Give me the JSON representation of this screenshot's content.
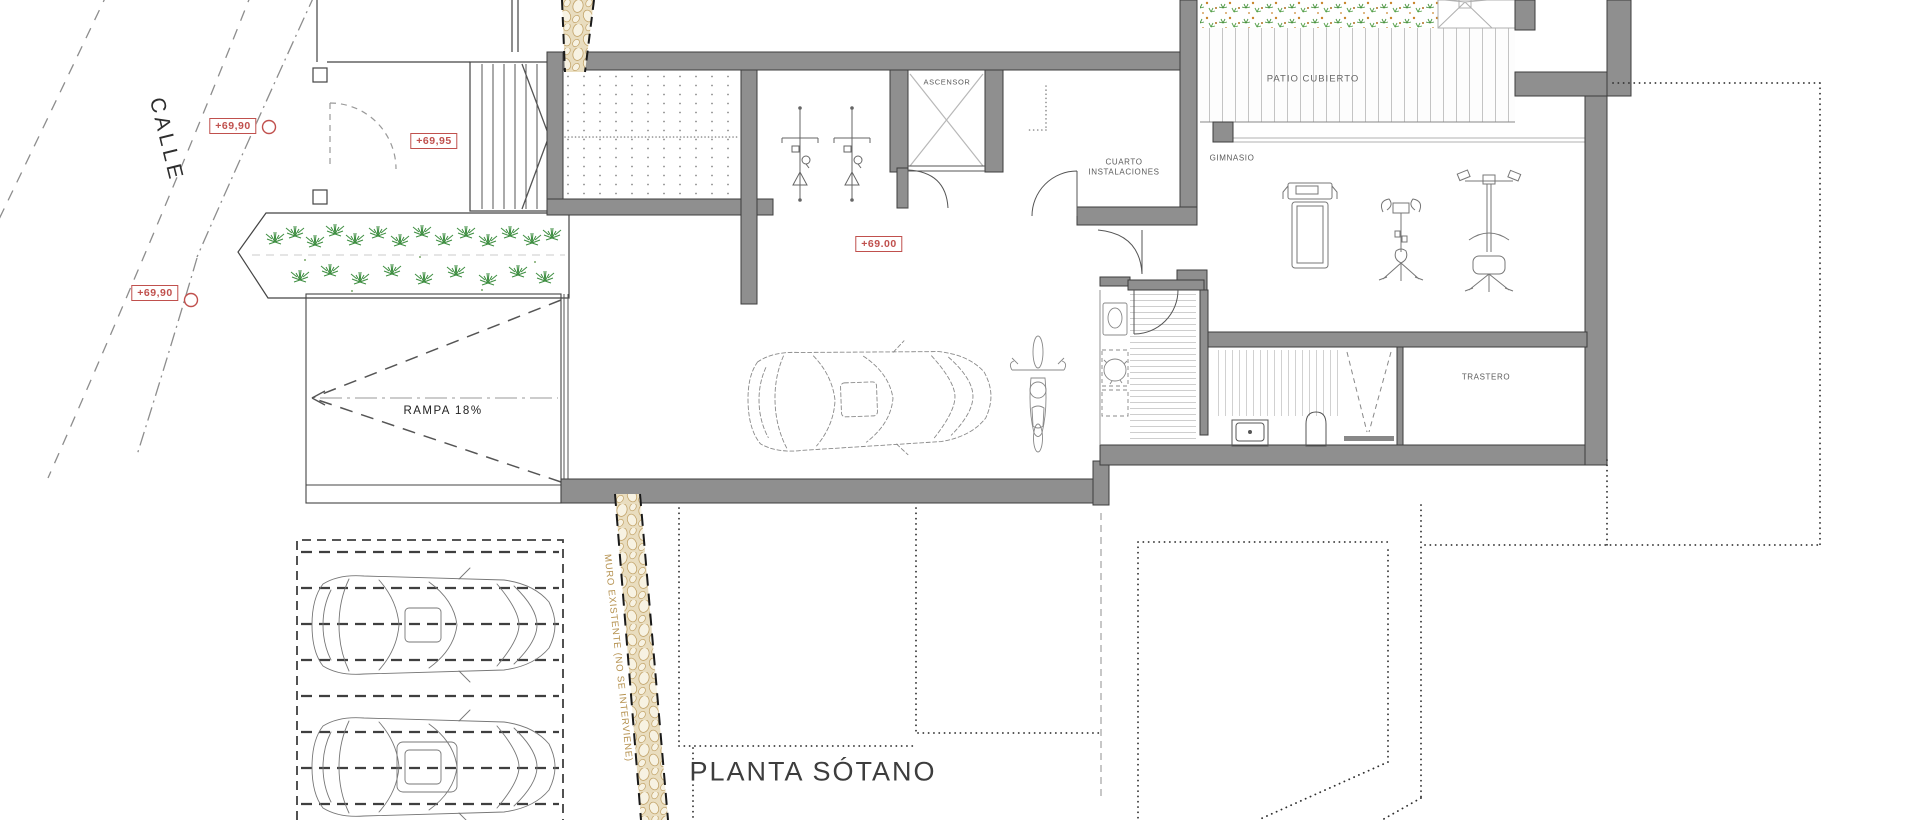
{
  "drawing": {
    "title": "PLANTA SÓTANO",
    "street": "CALLE",
    "ramp": "RAMPA  18%",
    "wall_note": "MURO EXISTENTE (NO SE INTERVIENE)",
    "levels": {
      "street_upper": "+69,90",
      "street_lower": "+69,90",
      "entry": "+69,95",
      "basement": "+69.00"
    },
    "rooms": {
      "elevator": "ASCENSOR",
      "utilities_l1": "CUARTO",
      "utilities_l2": "INSTALACIONES",
      "gym": "GIMNASIO",
      "patio": "PATIO CUBIERTO",
      "storage": "TRASTERO"
    },
    "colors": {
      "wall_fill": "#8f8f8f",
      "wall_edge": "#3d3d3d",
      "annotation": "#c0504d",
      "vegetation": "#4a9440",
      "stone": "#c9a96a"
    }
  }
}
